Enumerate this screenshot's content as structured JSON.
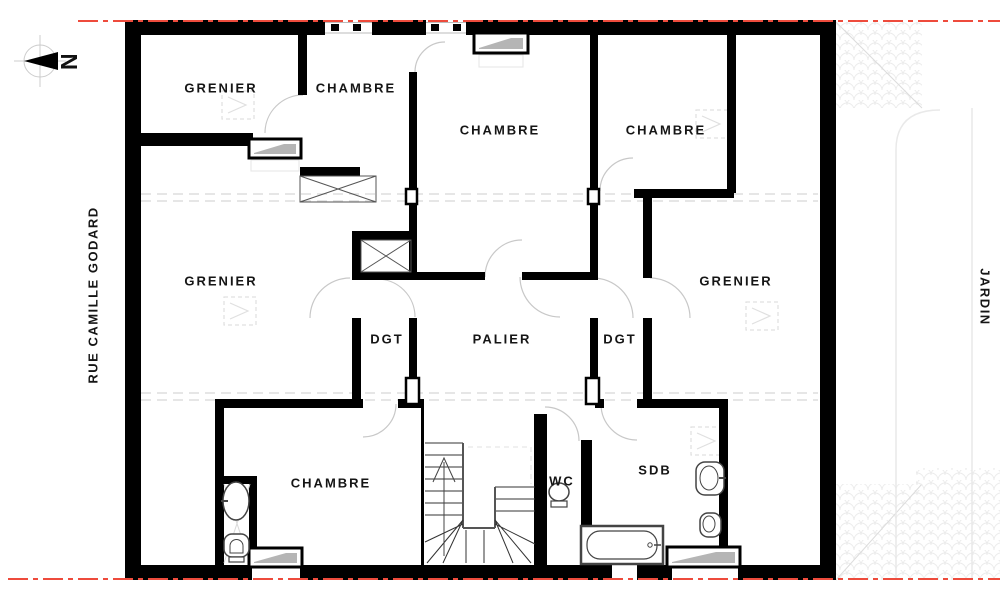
{
  "plan": {
    "north_label": "N",
    "left_street_label": "RUE CAMILLE GODARD",
    "right_area_label": "JARDIN",
    "rooms": [
      {
        "id": "grenier-top-left",
        "label": "GRENIER"
      },
      {
        "id": "chambre-top-left",
        "label": "CHAMBRE"
      },
      {
        "id": "chambre-top-center",
        "label": "CHAMBRE"
      },
      {
        "id": "chambre-top-right",
        "label": "CHAMBRE"
      },
      {
        "id": "grenier-left",
        "label": "GRENIER"
      },
      {
        "id": "grenier-right",
        "label": "GRENIER"
      },
      {
        "id": "degagement-left",
        "label": "DGT"
      },
      {
        "id": "palier",
        "label": "PALIER"
      },
      {
        "id": "degagement-right",
        "label": "DGT"
      },
      {
        "id": "chambre-bottom-left",
        "label": "CHAMBRE"
      },
      {
        "id": "wc",
        "label": "WC"
      },
      {
        "id": "salle-de-bain",
        "label": "SDB"
      }
    ],
    "colors": {
      "wall": "#000000",
      "parcel_line": "#ee4b3c",
      "window_glass": "#b5b5b5",
      "door_arc": "#c8c8c8"
    }
  }
}
